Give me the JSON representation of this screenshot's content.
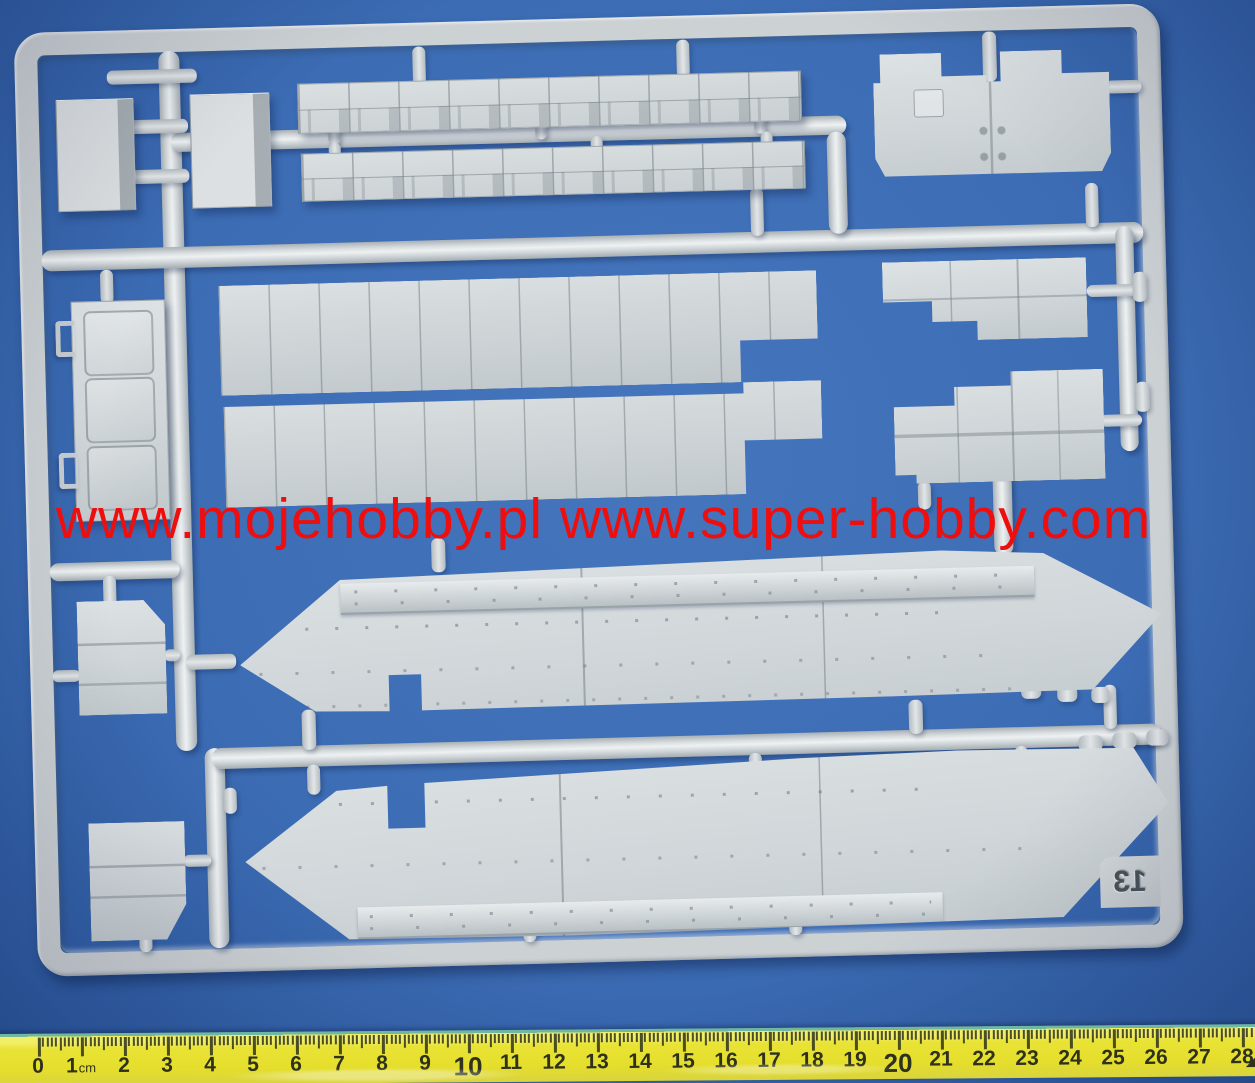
{
  "photo": {
    "subject": "injection-molded model kit sprue with hull and armor plate parts on blue background",
    "watermark": {
      "text": "www.mojehobby.pl www.super-hobby.com",
      "color": "#ee0e0e"
    },
    "sprue": {
      "marking": "13",
      "marking_mirrored": true,
      "plastic_color": "#ccd1d4"
    },
    "background_color": "#3c6cb4"
  },
  "colors": {
    "background_blue": "#3c6cb4",
    "background_edge": "#2c58a0",
    "plastic_gray": "#ccd1d4",
    "plastic_highlight": "#e9edef",
    "plastic_shadow": "#9aa3a8",
    "watermark_red": "#ee0e0e",
    "ruler_yellow": "#e9e336",
    "ruler_edge_green": "#6fb7a0",
    "ruler_tick": "#2e321c",
    "sprue_id_color": "#4a5259"
  },
  "ruler": {
    "unit_label": "cm",
    "numbers": [
      "0",
      "1",
      "2",
      "3",
      "4",
      "5",
      "6",
      "7",
      "8",
      "9",
      "10",
      "11",
      "12",
      "13",
      "14",
      "15",
      "16",
      "17",
      "18",
      "19",
      "20",
      "21",
      "22",
      "23",
      "24",
      "25",
      "26",
      "27",
      "28"
    ],
    "emphasized": [
      "10",
      "20"
    ],
    "end_marker": "◢"
  },
  "parts": [
    {
      "id": "small-box-part-a"
    },
    {
      "id": "small-box-part-b"
    },
    {
      "id": "track-guard-strip-1"
    },
    {
      "id": "track-guard-strip-2"
    },
    {
      "id": "rear-plate-part"
    },
    {
      "id": "hatch-column-part"
    },
    {
      "id": "large-deck-panel-1"
    },
    {
      "id": "large-deck-panel-2"
    },
    {
      "id": "stepped-plate-1"
    },
    {
      "id": "stepped-plate-2"
    },
    {
      "id": "small-plate-mid-left"
    },
    {
      "id": "small-plate-bottom-left"
    },
    {
      "id": "hull-side-panel-upper"
    },
    {
      "id": "hull-side-panel-lower"
    }
  ]
}
